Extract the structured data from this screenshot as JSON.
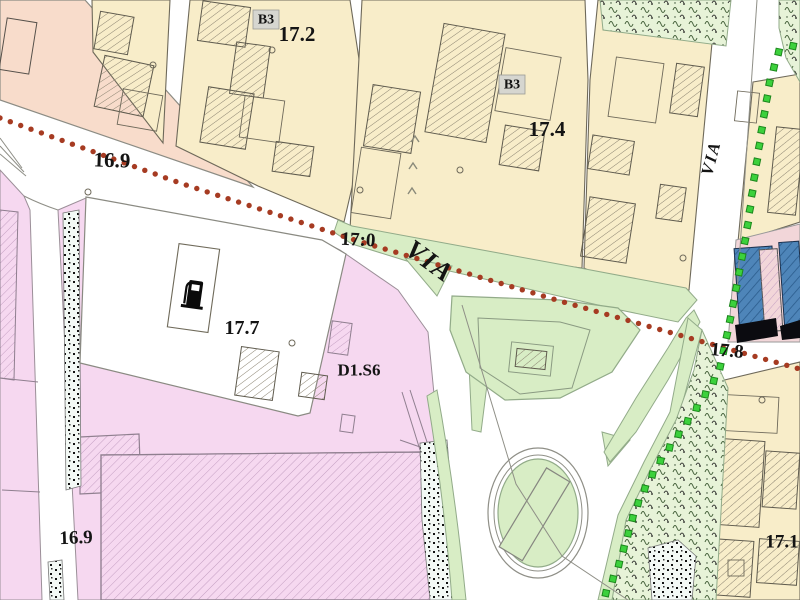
{
  "app": {
    "type": "map-viewer",
    "description": "Cadastral urban zoning plan with roundabout, roads and elevation labels"
  },
  "map": {
    "colors": {
      "salmon_block": "#f8dccb",
      "cream_block": "#f8edc9",
      "block_outline": "#6e695a",
      "road_line": "#8f8f87",
      "pink_zone": "#f6d8f0",
      "pink_strip": "#f2d6d9",
      "green_area": "#d8edc5",
      "green_outline": "#92ab89",
      "vegetation_bg": "#e7f3d8",
      "stipple_bg": "#f3f9f5",
      "blue_building": "#4e85b9",
      "red_dot_line": "#a63b22",
      "green_square_line": "#3cd13c",
      "label_color": "#141414",
      "b3_box": "#d6d6d0"
    },
    "labels": [
      {
        "id": "elev-16-9-top",
        "text": "16.9",
        "x": 112,
        "y": 160,
        "size": 21,
        "rot": 2,
        "style": "plain"
      },
      {
        "id": "zone-b3-1",
        "text": "B3",
        "x": 266,
        "y": 20,
        "size": 14,
        "rot": 0,
        "style": "boxed"
      },
      {
        "id": "elev-17-2",
        "text": "17.2",
        "x": 297,
        "y": 34,
        "size": 21,
        "rot": 0,
        "style": "plain"
      },
      {
        "id": "zone-b3-2",
        "text": "B3",
        "x": 512,
        "y": 85,
        "size": 14,
        "rot": 0,
        "style": "boxed"
      },
      {
        "id": "elev-17-4",
        "text": "17.4",
        "x": 547,
        "y": 129,
        "size": 21,
        "rot": 0,
        "style": "plain"
      },
      {
        "id": "elev-17-0",
        "text": "17:0",
        "x": 358,
        "y": 240,
        "size": 19,
        "rot": 3,
        "style": "plain"
      },
      {
        "id": "via-main",
        "text": "VIA",
        "x": 430,
        "y": 261,
        "size": 27,
        "rot": 36,
        "style": "italic"
      },
      {
        "id": "via-right",
        "text": "VIA",
        "x": 711,
        "y": 158,
        "size": 17,
        "rot": -75,
        "style": "italic"
      },
      {
        "id": "elev-17-7",
        "text": "17.7",
        "x": 242,
        "y": 328,
        "size": 20,
        "rot": 0,
        "style": "plain"
      },
      {
        "id": "zone-d1s6",
        "text": "D1.S6",
        "x": 359,
        "y": 370,
        "size": 17,
        "rot": 0,
        "style": "plain"
      },
      {
        "id": "elev-17-8",
        "text": "17.8",
        "x": 727,
        "y": 351,
        "size": 19,
        "rot": 5,
        "style": "plain"
      },
      {
        "id": "elev-16-9-bottom",
        "text": "16.9",
        "x": 76,
        "y": 538,
        "size": 19,
        "rot": -2,
        "style": "plain"
      },
      {
        "id": "elev-17-1",
        "text": "17.1",
        "x": 782,
        "y": 542,
        "size": 19,
        "rot": 0,
        "style": "plain"
      }
    ],
    "red_dotted_line": {
      "color": "#a63b22",
      "dot_radius": 2.7,
      "spacing": 11,
      "points": [
        [
          0,
          118
        ],
        [
          180,
          183
        ],
        [
          358,
          241
        ],
        [
          560,
          301
        ],
        [
          700,
          341
        ],
        [
          800,
          369
        ]
      ]
    },
    "green_dotted_line": {
      "color": "#3cd13c",
      "square_size": 6.5,
      "spacing": 16,
      "points": [
        [
          793,
          46
        ],
        [
          779,
          51
        ],
        [
          770,
          80
        ],
        [
          762,
          128
        ],
        [
          754,
          180
        ],
        [
          747,
          230
        ],
        [
          740,
          268
        ],
        [
          733,
          305
        ],
        [
          726,
          340
        ],
        [
          719,
          372
        ],
        [
          707,
          392
        ],
        [
          694,
          412
        ],
        [
          676,
          438
        ],
        [
          659,
          463
        ],
        [
          646,
          486
        ],
        [
          635,
          510
        ],
        [
          627,
          538
        ],
        [
          619,
          564
        ],
        [
          610,
          586
        ],
        [
          603,
          598
        ]
      ]
    },
    "markers": {
      "circles": [
        [
          153,
          65
        ],
        [
          272,
          50
        ],
        [
          460,
          170
        ],
        [
          360,
          190
        ],
        [
          292,
          343
        ],
        [
          762,
          400
        ],
        [
          88,
          192
        ],
        [
          683,
          258
        ]
      ],
      "chevrons": [
        [
          415,
          139
        ],
        [
          413,
          166
        ],
        [
          412,
          191
        ]
      ]
    },
    "icons": [
      {
        "name": "fuel-pump-icon",
        "meaning": "gas station",
        "x": 196,
        "y": 293
      }
    ]
  }
}
